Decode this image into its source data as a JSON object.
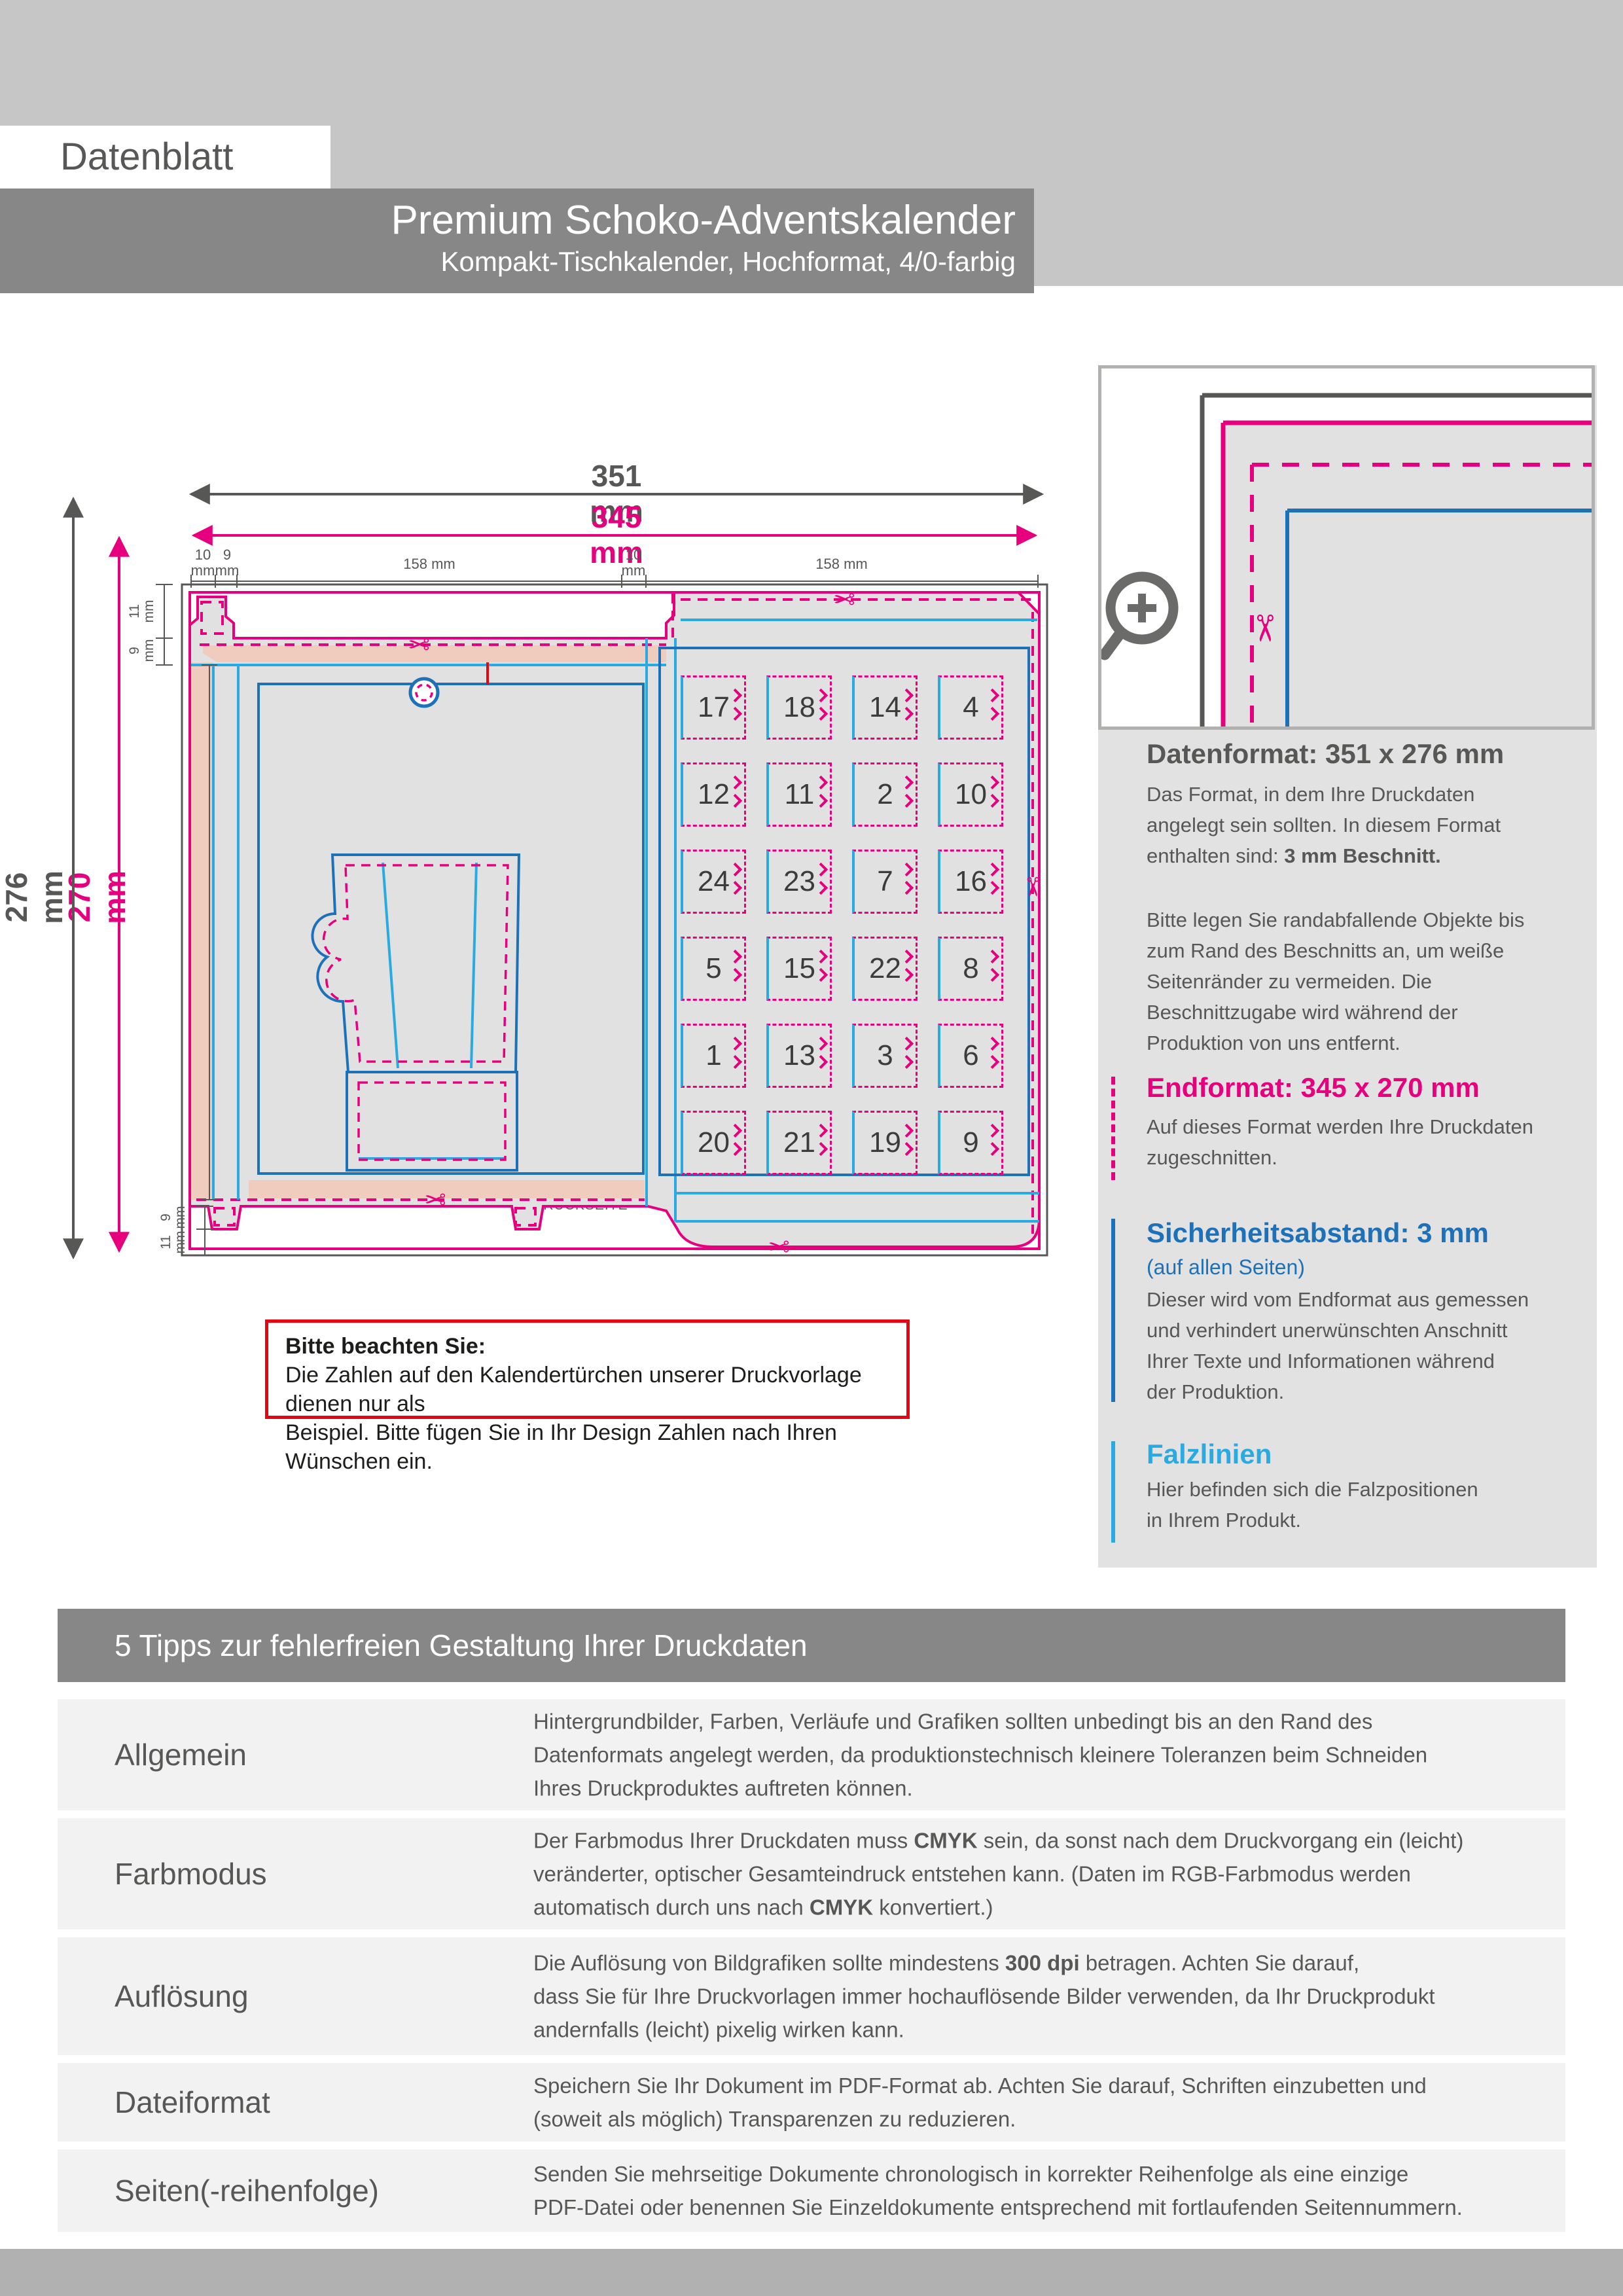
{
  "header": {
    "label": "Datenblatt",
    "product_title": "Premium Schoko-Adventskalender",
    "product_subtitle": "Kompakt-Tischkalender, Hochformat, 4/0-farbig"
  },
  "icons": {
    "scissors": "✂",
    "recycle": "♻",
    "magnifier": "zoom-plus"
  },
  "diagram": {
    "dims": {
      "w_outer": "351 mm",
      "w_inner": "345 mm",
      "h_outer": "276 mm",
      "h_inner": "270 mm",
      "side": "231 mm",
      "top_segments": [
        "10\nmm",
        "9\nmm",
        "158 mm",
        "10\nmm",
        "158 mm"
      ],
      "top_left_edge": [
        "11\nmm",
        "9\nmm"
      ],
      "bottom_left_edge": [
        "9\nmm",
        "11\nmm"
      ]
    },
    "panel_labels": {
      "deckel": "DECKELSEITE",
      "links": "SEITE LINKS",
      "rechts": "SEITE RECHTS",
      "rueck": "RÜCKSEITE",
      "vorder": "VORDERSEITE",
      "boden": "BODENSEITE"
    },
    "doors": [
      [
        17,
        18,
        14,
        4
      ],
      [
        12,
        11,
        2,
        10
      ],
      [
        24,
        23,
        7,
        16
      ],
      [
        5,
        15,
        22,
        8
      ],
      [
        1,
        13,
        3,
        6
      ],
      [
        20,
        21,
        19,
        9
      ]
    ],
    "annotations": {
      "fold_hidden": "Bitte achten Sie darauf,\ndass die rot markierten\nBereiche im gefalteten\nZustand nicht zu sehen sind.",
      "nutrition_area": "In diesen Bereich werden die\nNährwertangaben platziert.\nIhre Bilder werden von der\nProduktion abgesoftet.",
      "numbers_example": "Bitte beachten Sie:\nDie Zahlen auf den Kalendertürchen\nunserer Druckvorlage dienen nur als\nBeispiel. Bitte fügen Sie in Ihr Design\nZahlen nach Ihren Wünschen ein."
    },
    "nutrition": {
      "heading": "Edel-Vollmilchschokolade, Kakao: 33,6% mindestens",
      "ingredients": "Zutaten: Zucker; Kakaobutter; VOLLMILCHPULVER; Kakaomasse; Emulgator: SOJA-LECITHIN; natürliches Vanille-Aroma.\nKann Spuren von MANDELN, HASELNÜSSEN enthalten",
      "table_title": "Durchschnittliche Nährwerte pro 100 g:",
      "rows": [
        [
          "Energie",
          "2.356 kJ / 563 kcal"
        ],
        [
          "Fett",
          "36,2 g"
        ],
        [
          "davon gesättigte Fettsäuren",
          "21,8 g"
        ],
        [
          "Kohlenhydrate",
          "50,9 g"
        ],
        [
          "davon Zucker",
          "49,9 g"
        ],
        [
          "Eiweiß",
          "7 g"
        ],
        [
          "Salz",
          "0,21 g"
        ]
      ],
      "mhd_label": "Mindestens haltbar bis:",
      "mhd_date": "01.04.2026",
      "made_in": "Made in Germany",
      "weight": "60 g",
      "distribution": "Vertrieb durch:"
    },
    "cocoa": {
      "logo": "cocoa",
      "sub": "HORIZONS",
      "url1": "cocoahorizons.org",
      "url2": "callebaut.com/sustainable",
      "fine": "Dieses Programm wird kofinanziert\ndurch die Cocoa Horizons Foundation."
    },
    "recycle": {
      "line1": "100% recyceln",
      "line2": "Nimm mich auseinander"
    }
  },
  "note_box": {
    "title": "Bitte beachten Sie:",
    "body": "Die Zahlen auf den Kalendertürchen unserer Druckvorlage dienen nur als\nBeispiel. Bitte fügen Sie in Ihr Design Zahlen nach Ihren Wünschen ein."
  },
  "sidebar": {
    "datenformat": {
      "title": "Datenformat: 351 x 276 mm",
      "body1": [
        {
          "t": "Das Format, in dem Ihre Druckdaten\nangelegt sein sollten. In diesem Format\nenthalten sind: "
        },
        {
          "t": "3 mm Beschnitt.",
          "b": true
        }
      ],
      "body2": "Bitte legen Sie randabfallende Objekte bis\nzum Rand des Beschnitts an, um weiße\nSeitenränder zu vermeiden. Die\nBeschnittzugabe wird während der\nProduktion von uns entfernt."
    },
    "endformat": {
      "title": "Endformat: 345 x 270 mm",
      "body": "Auf dieses Format werden Ihre Druckdaten\nzugeschnitten."
    },
    "sicherheit": {
      "title": "Sicherheitsabstand: 3 mm",
      "subtitle": "(auf allen Seiten)",
      "body": "Dieser wird vom Endformat aus gemessen\nund verhindert unerwünschten Anschnitt\nIhrer Texte und Informationen während\nder Produktion."
    },
    "falzlinien": {
      "title": "Falzlinien",
      "body": "Hier befinden sich die Falzpositionen\nin Ihrem Produkt."
    }
  },
  "tips": {
    "title": "5 Tipps zur fehlerfreien Gestaltung Ihrer Druckdaten",
    "rows": [
      {
        "label": "Allgemein",
        "parts": [
          {
            "t": "Hintergrundbilder, Farben, Verläufe und Grafiken sollten unbedingt bis an den Rand des\nDatenformats angelegt werden, da produktionstechnisch kleinere Toleranzen beim Schneiden\nIhres Druckproduktes auftreten können."
          }
        ]
      },
      {
        "label": "Farbmodus",
        "parts": [
          {
            "t": "Der Farbmodus Ihrer Druckdaten muss "
          },
          {
            "t": "CMYK",
            "b": true
          },
          {
            "t": " sein, da sonst nach dem Druckvorgang ein (leicht)\nveränderter, optischer Gesamteindruck entstehen kann. (Daten im RGB-Farbmodus werden\nautomatisch durch uns nach "
          },
          {
            "t": "CMYK",
            "b": true
          },
          {
            "t": " konvertiert.)"
          }
        ]
      },
      {
        "label": "Auflösung",
        "parts": [
          {
            "t": "Die Auflösung von Bildgrafiken sollte mindestens "
          },
          {
            "t": "300 dpi",
            "b": true
          },
          {
            "t": " betragen. Achten Sie darauf,\ndass Sie für Ihre Druckvorlagen immer hochauflösende Bilder verwenden, da Ihr Druckprodukt\nandernfalls (leicht) pixelig wirken kann."
          }
        ]
      },
      {
        "label": "Dateiformat",
        "parts": [
          {
            "t": "Speichern Sie Ihr Dokument im PDF-Format ab. Achten Sie darauf, Schriften einzubetten und\n(soweit als möglich) Transparenzen zu reduzieren."
          }
        ]
      },
      {
        "label": "Seiten(-reihenfolge)",
        "parts": [
          {
            "t": "Senden Sie mehrseitige Dokumente chronologisch in korrekter Reihenfolge als eine einzige\nPDF-Datei oder benennen Sie Einzeldokumente entsprechend mit fortlaufenden Seitennummern."
          }
        ]
      }
    ]
  }
}
